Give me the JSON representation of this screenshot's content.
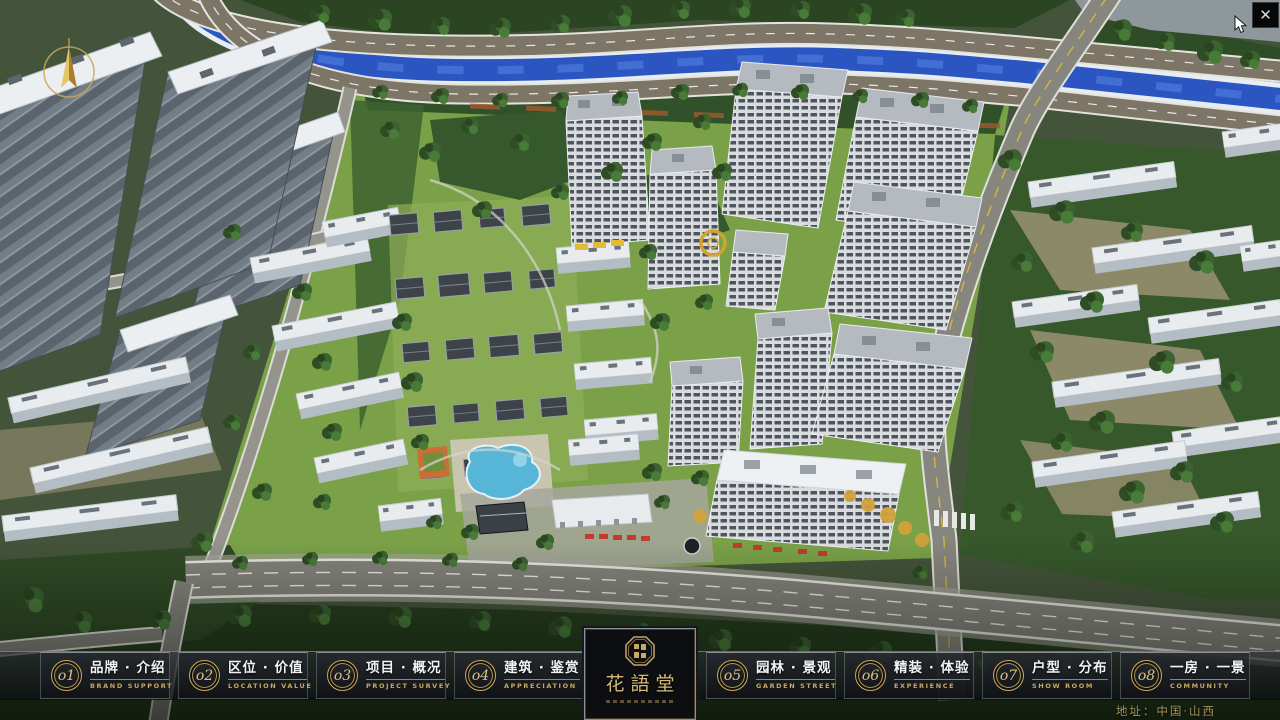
{
  "app": {
    "close_label": "✕"
  },
  "colors": {
    "accent_gold": "#c9a860",
    "bar_text": "#f2f3f5",
    "panel_bg": "#0c0e11",
    "address_gold": "#b3a167"
  },
  "menu": {
    "items": [
      {
        "num": "o1",
        "zh": "品牌 · 介绍",
        "en": "BRAND SUPPORT"
      },
      {
        "num": "o2",
        "zh": "区位 · 价值",
        "en": "LOCATION VALUE"
      },
      {
        "num": "o3",
        "zh": "项目 · 概况",
        "en": "PROJECT SURVEY"
      },
      {
        "num": "o4",
        "zh": "建筑 · 鉴赏",
        "en": "APPRECIATION"
      },
      {
        "num": "o5",
        "zh": "园林 · 景观",
        "en": "GARDEN STREET"
      },
      {
        "num": "o6",
        "zh": "精装 · 体验",
        "en": "EXPERIENCE"
      },
      {
        "num": "o7",
        "zh": "户型 · 分布",
        "en": "SHOW ROOM"
      },
      {
        "num": "o8",
        "zh": "一房 · 一景",
        "en": "COMMUNITY"
      }
    ]
  },
  "logo": {
    "title": "花語堂"
  },
  "footer": {
    "address": "地址：中国·山西"
  }
}
